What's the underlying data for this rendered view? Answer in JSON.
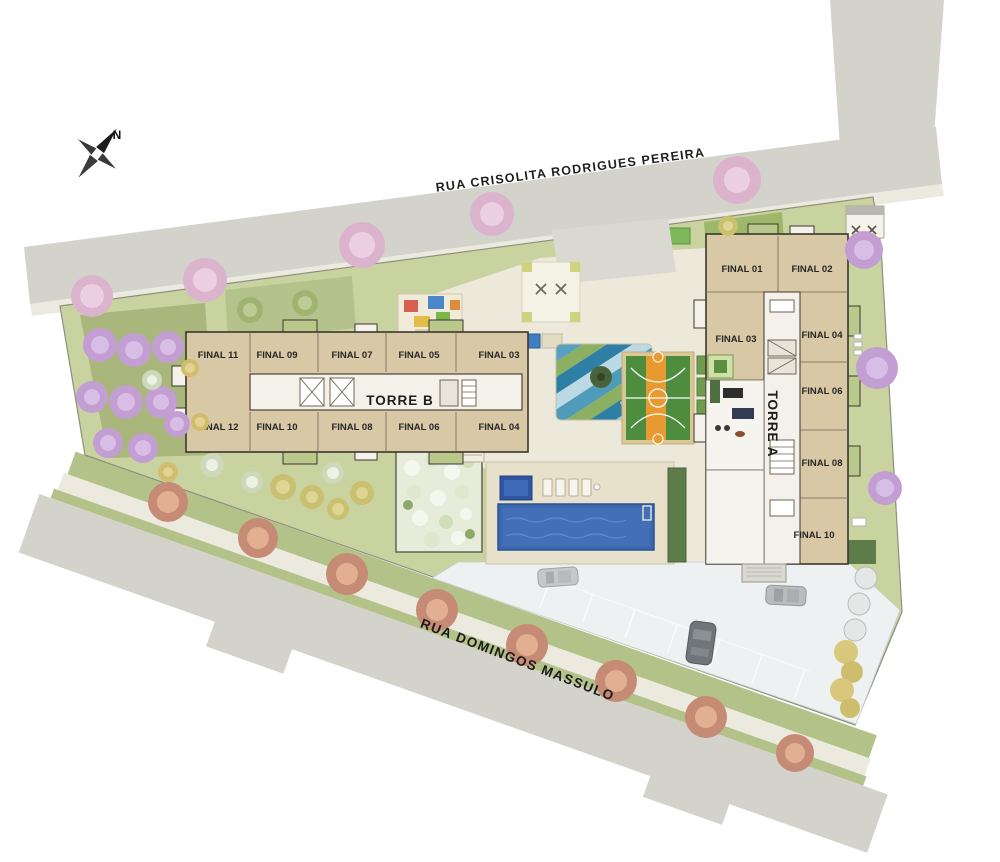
{
  "compass": {
    "north_label": "N"
  },
  "streets": {
    "top_street": "RUA CRISOLITA RODRIGUES PEREIRA",
    "bottom_street": "RUA DOMINGOS MASSULO"
  },
  "towers": {
    "torre_a": {
      "label": "TORRE A",
      "units": [
        "FINAL 01",
        "FINAL 02",
        "FINAL 03",
        "FINAL 04",
        "FINAL 06",
        "FINAL 08",
        "FINAL 10"
      ]
    },
    "torre_b": {
      "label": "TORRE B",
      "units_top_row": [
        "FINAL 11",
        "FINAL 09",
        "FINAL 07",
        "FINAL 05",
        "FINAL 03"
      ],
      "units_bottom_row": [
        "FINAL 12",
        "FINAL 10",
        "FINAL 08",
        "FINAL 06",
        "FINAL 04"
      ]
    }
  },
  "features": {
    "icons": [
      "compass-rose-icon",
      "swimming-pool",
      "kids-pool",
      "sports-court",
      "playground",
      "water-garden",
      "pool-deck",
      "parking-area",
      "street-trees"
    ]
  },
  "palette": {
    "street": "#d4d3cb",
    "sidewalk": "#eceadf",
    "grass": "#c9d3a0",
    "building": "#d9c8a6",
    "corridor": "#f3f1e9",
    "pool_blue": "#3a67ad",
    "court_green": "#4e8c3e",
    "court_orange": "#e8992f",
    "tree_pink": "#dcb3cd",
    "tree_purple": "#c29ed3",
    "tree_orange": "#c68b74",
    "label_ink": "#262626"
  }
}
